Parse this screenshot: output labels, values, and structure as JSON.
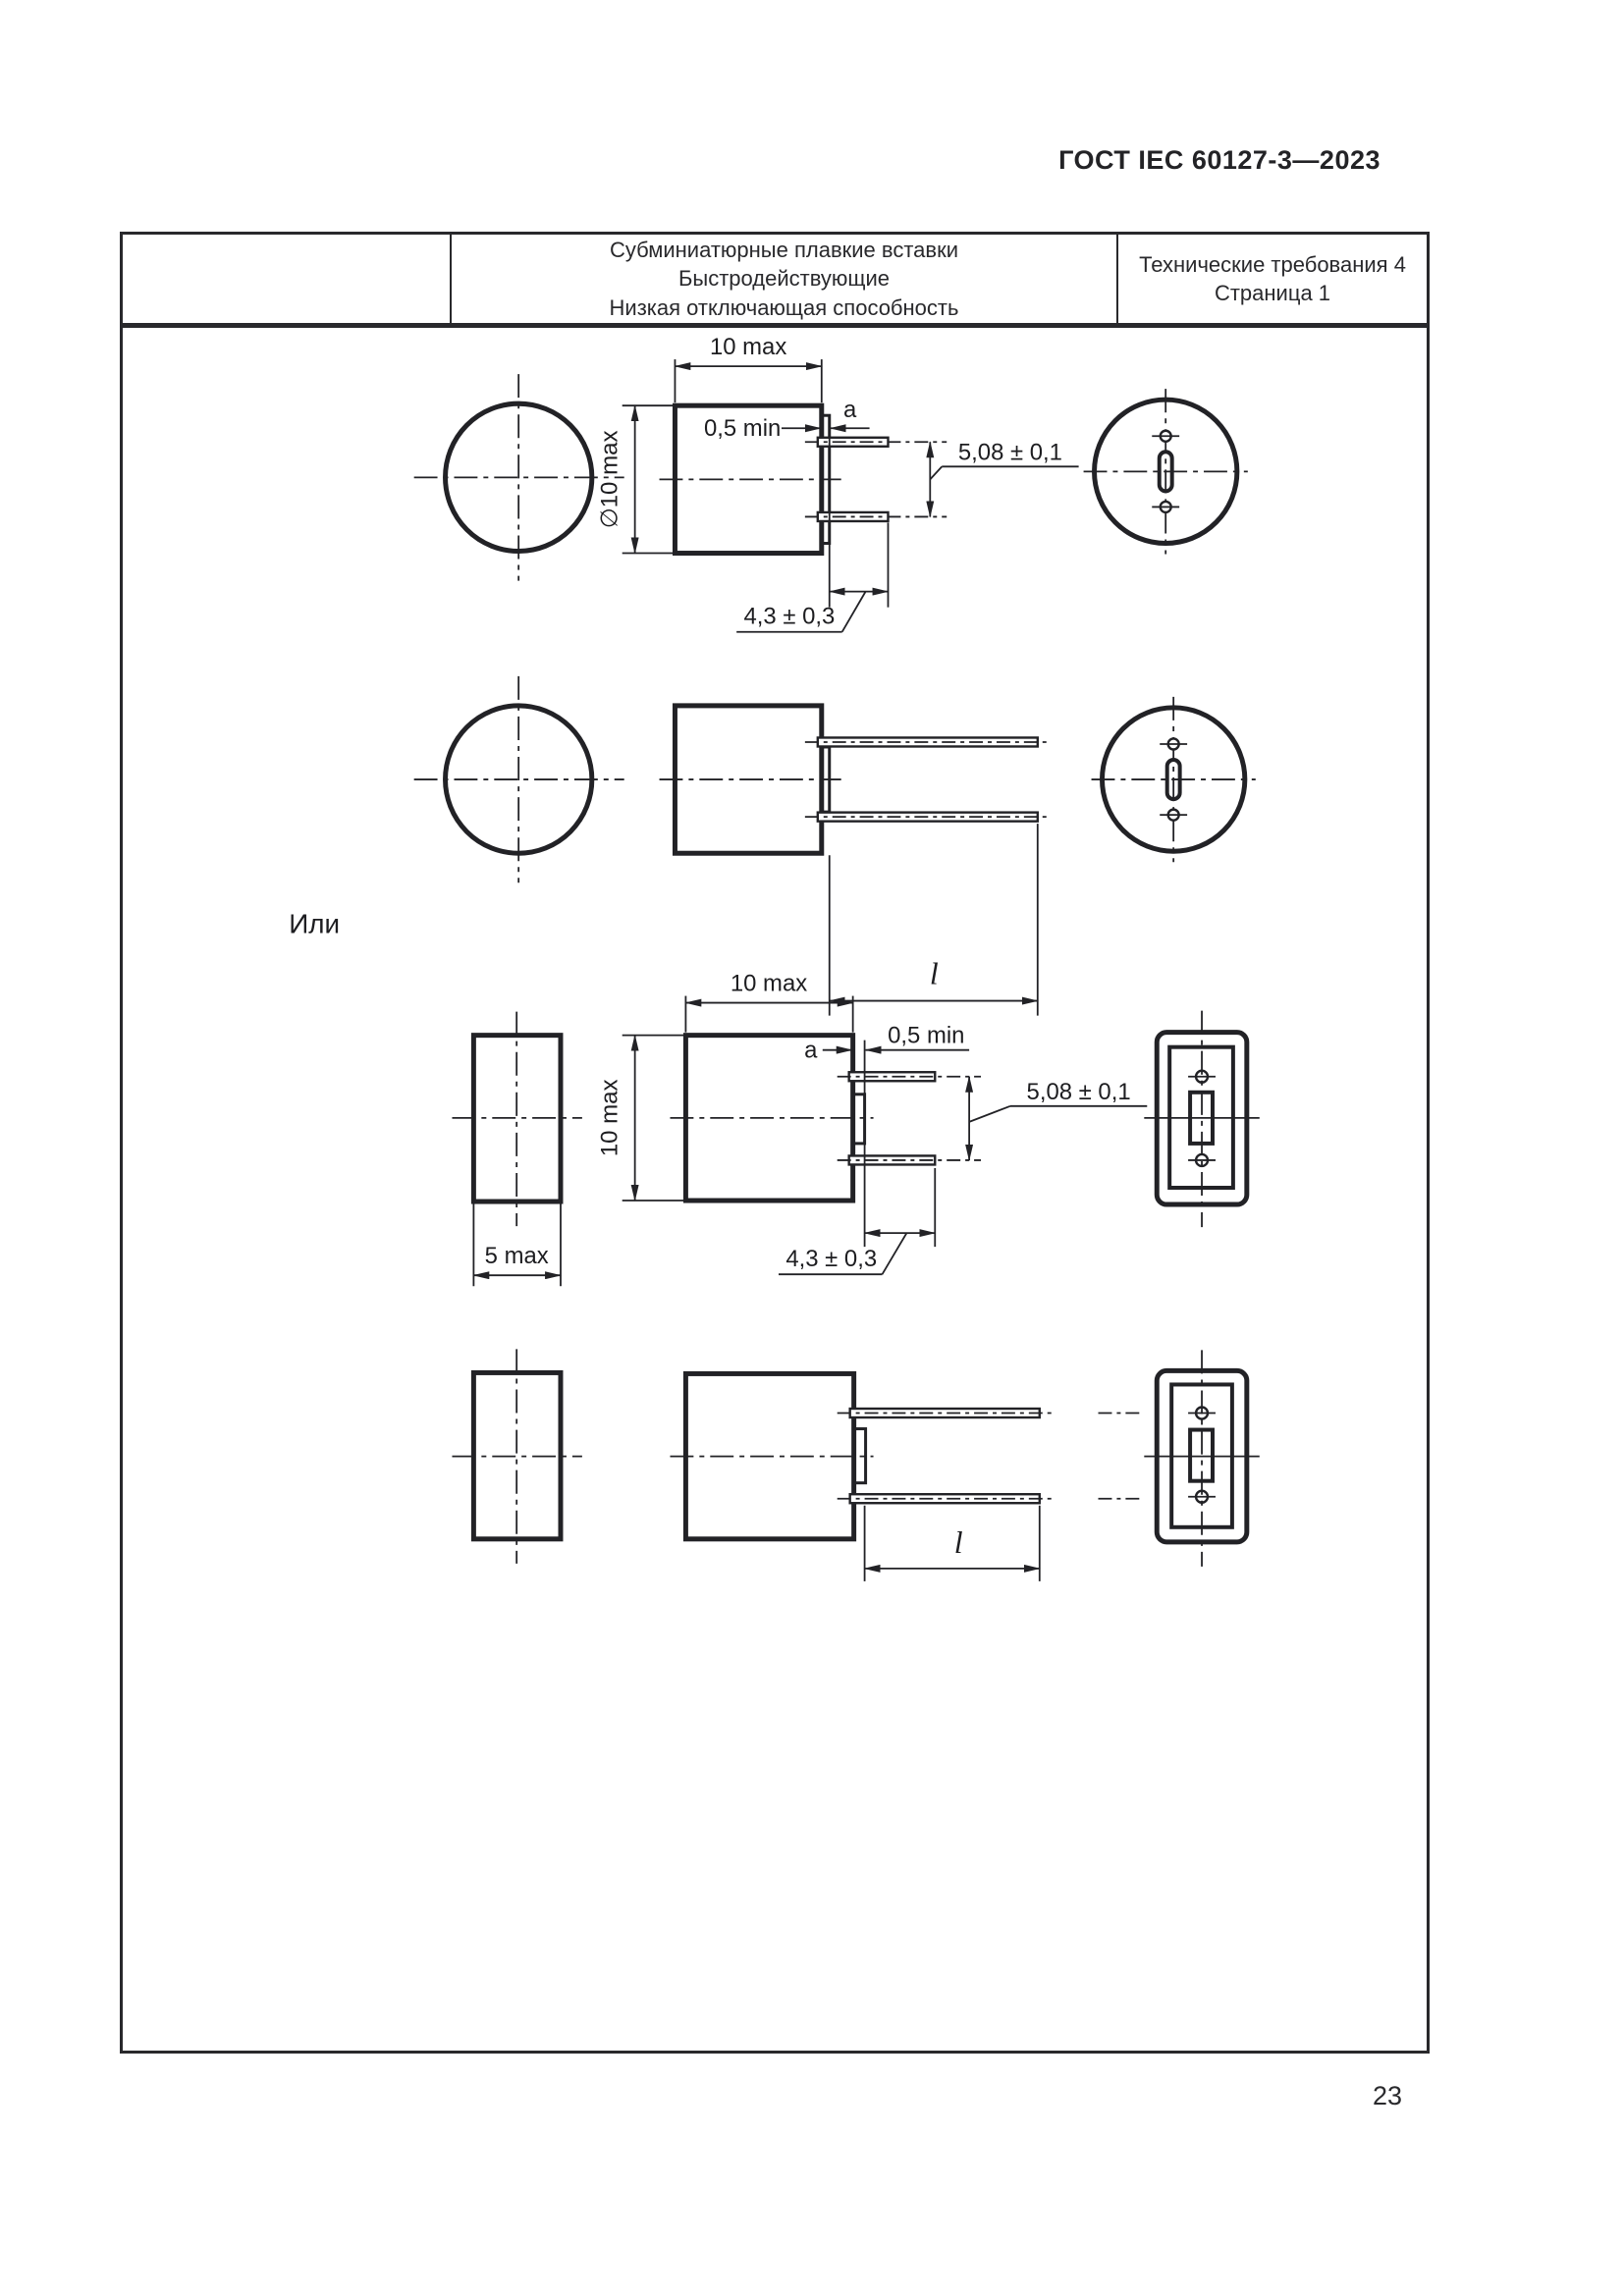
{
  "page": {
    "header_title": "ГОСТ IEC 60127-3—2023",
    "page_number": "23"
  },
  "table": {
    "col1": "",
    "col2_lines": [
      "Субминиатюрные плавкие вставки",
      "Быстродействующие",
      "Низкая отключающая способность"
    ],
    "col3_lines": [
      "Технические требования 4",
      "Страница 1"
    ]
  },
  "drawing": {
    "or_label": "Или",
    "dims": {
      "width_10max": "10 max",
      "dia_10max": "∅10 max",
      "gap_05min": "0,5 min",
      "a_label": "a",
      "pitch_508": "5,08 ± 0,1",
      "lead_43": "4,3 ± 0,3",
      "thickness_5max": "5 max",
      "height_10max": "10 max",
      "length_l": "l"
    }
  }
}
